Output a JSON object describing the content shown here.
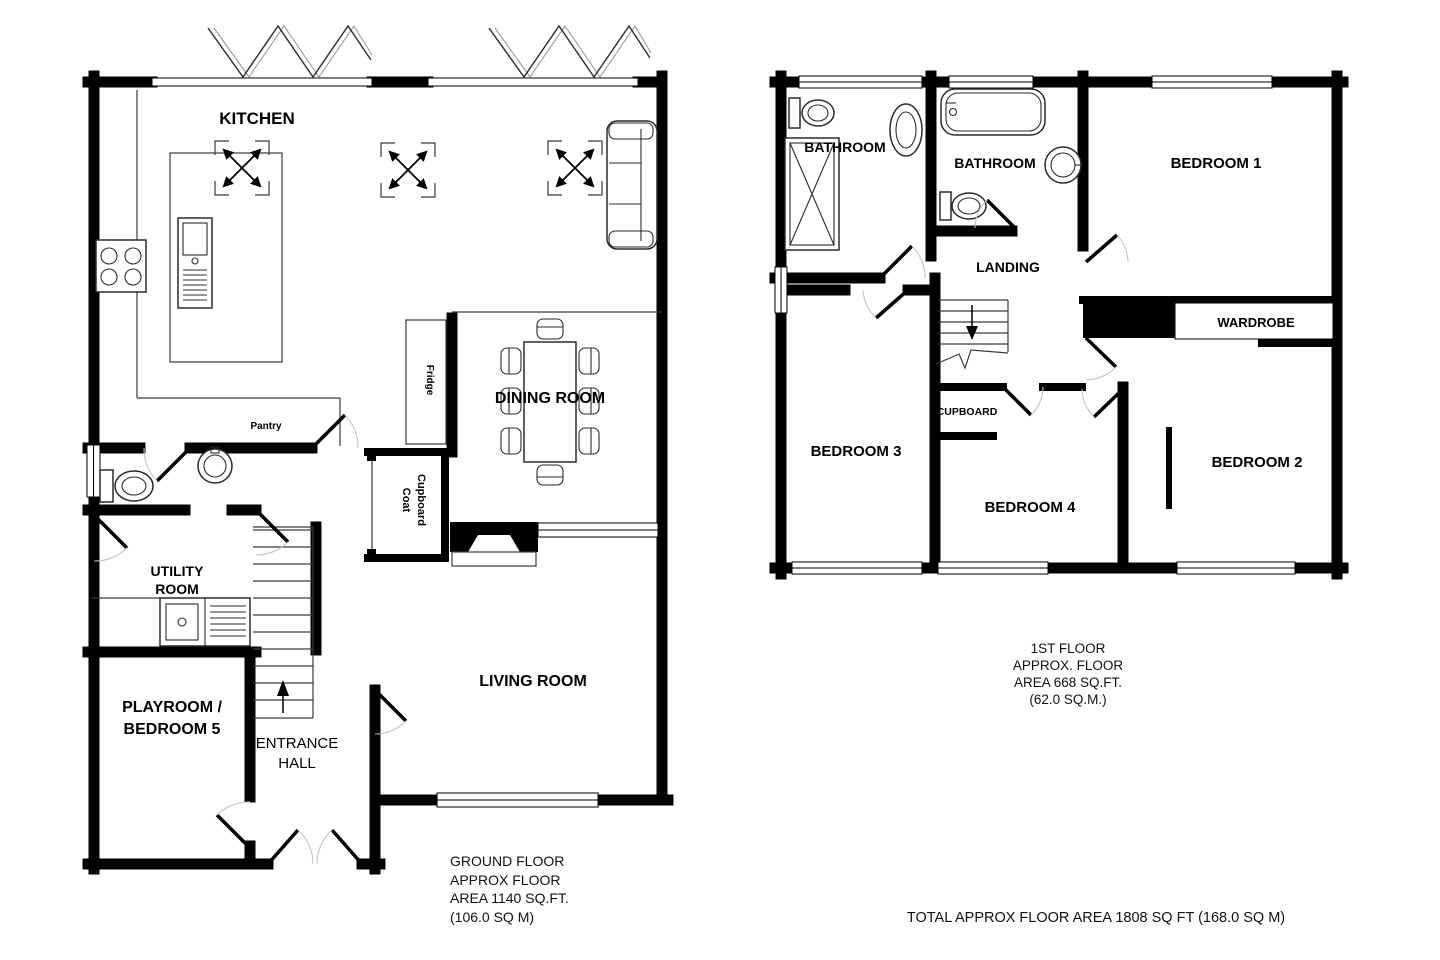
{
  "ground_floor": {
    "labels": {
      "kitchen": "KITCHEN",
      "dining_room": "DINING ROOM",
      "fridge": "Fridge",
      "pantry": "Pantry",
      "coat_line1": "Coat",
      "coat_line2": "Cupboard",
      "utility_line1": "UTILITY",
      "utility_line2": "ROOM",
      "playroom_line1": "PLAYROOM /",
      "playroom_line2": "BEDROOM 5",
      "hall_line1": "ENTRANCE",
      "hall_line2": "HALL",
      "living_room": "LIVING ROOM"
    },
    "caption": [
      "GROUND FLOOR",
      "APPROX FLOOR",
      "AREA 1140 SQ.FT.",
      "(106.0 SQ M)"
    ]
  },
  "first_floor": {
    "labels": {
      "bathroom1": "BATHROOM",
      "bathroom2": "BATHROOM",
      "bedroom1": "BEDROOM 1",
      "landing": "LANDING",
      "wardrobe": "WARDROBE",
      "cupboard": "CUPBOARD",
      "bedroom3": "BEDROOM 3",
      "bedroom4": "BEDROOM 4",
      "bedroom2": "BEDROOM 2"
    },
    "caption": [
      "1ST FLOOR",
      "APPROX. FLOOR",
      "AREA 668 SQ.FT.",
      "(62.0 SQ.M.)"
    ]
  },
  "footer": {
    "total": "TOTAL APPROX FLOOR AREA 1808 SQ FT (168.0 SQ M)"
  },
  "colors": {
    "wall": "#000000",
    "line": "#3a3a3a",
    "door_arc": "#c3c3c3",
    "background": "#ffffff"
  }
}
